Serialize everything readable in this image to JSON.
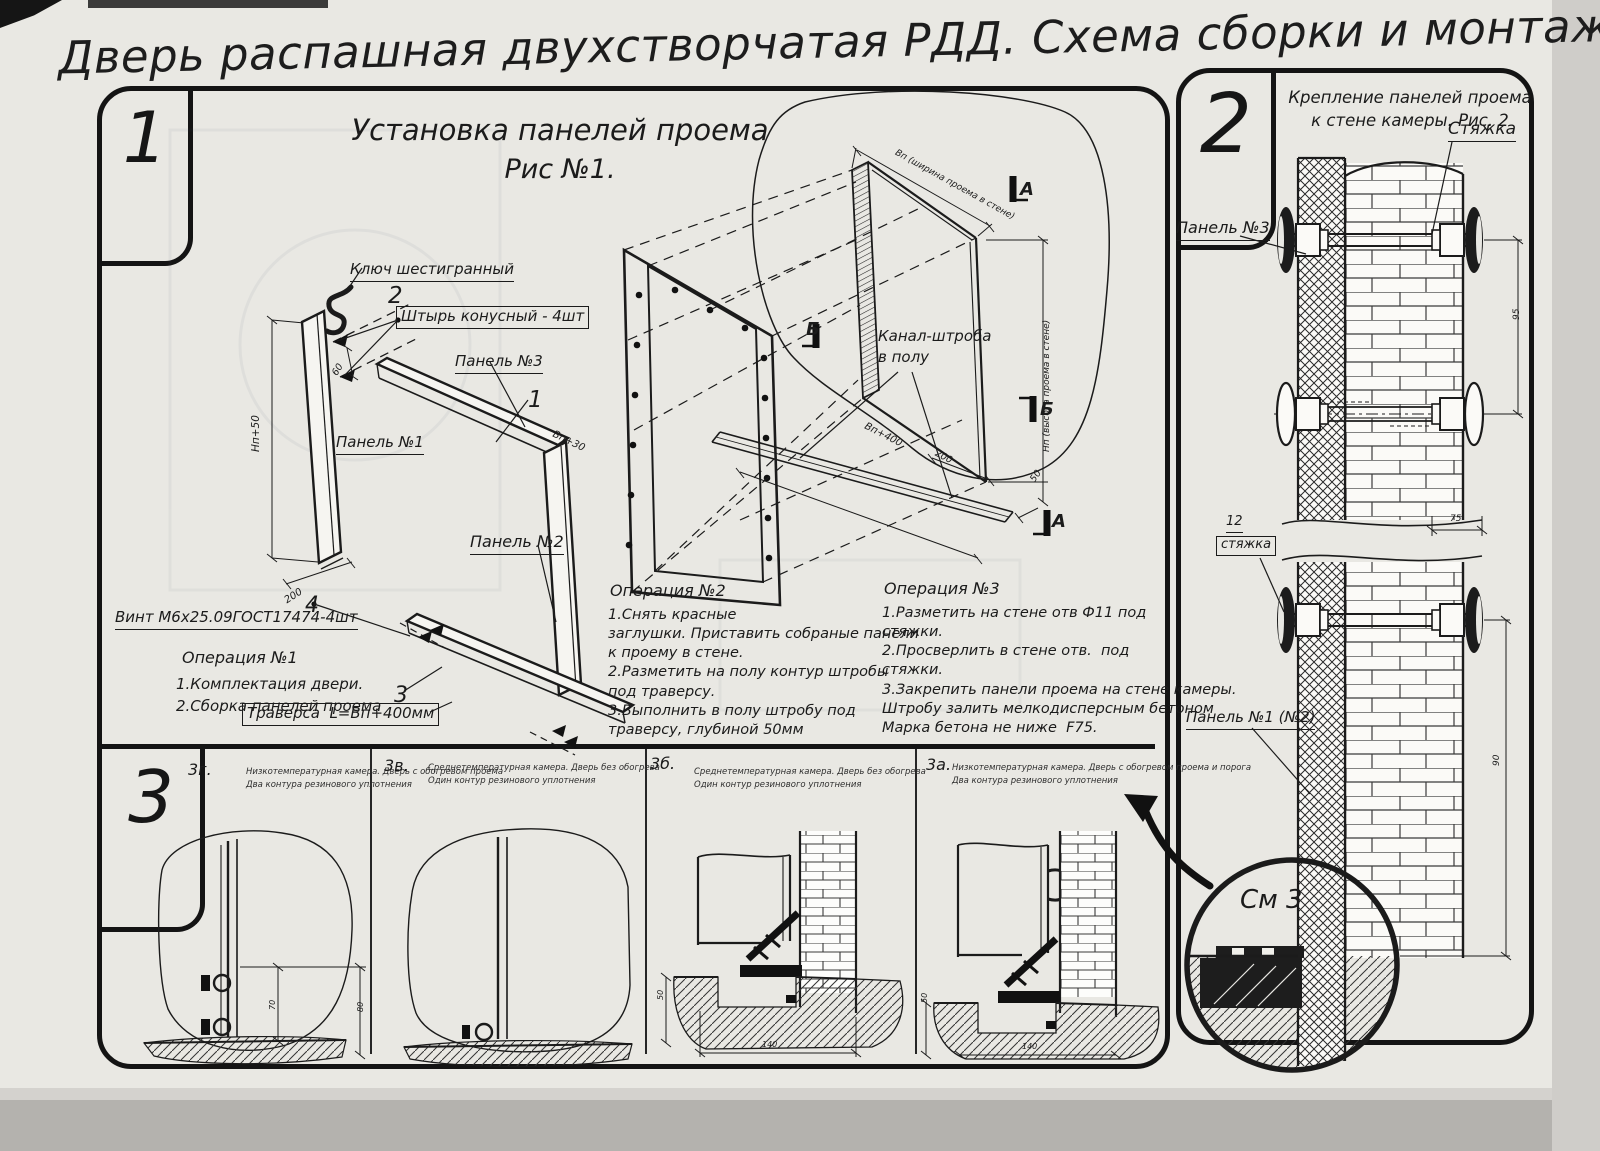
{
  "page": {
    "title": "Дверь распашная двухстворчатая РДД.  Схема сборки и монтажа №2",
    "colors": {
      "ink": "#1b1b1b",
      "paper": "#e9e8e3"
    }
  },
  "fig1": {
    "badge": "1",
    "title": "Установка панелей проема",
    "subtitle": "Рис №1.",
    "labels": {
      "hex_key": "Ключ шестигранный",
      "pin": "Штырь конусный - 4шт",
      "panel3": "Панель №3",
      "panel1": "Панель №1",
      "panel2": "Панель №2",
      "screw": "Винт М6х25.09ГОСТ17474-4шт",
      "traverse": "Траверса  L=Вп+400мм",
      "channel": "Канал-штроба\nв полу",
      "callout_1": "1",
      "callout_2": "2",
      "callout_3": "3",
      "callout_4": "4",
      "marker_a": "А",
      "marker_b": "Б"
    },
    "dims": {
      "np50": "Нп+50",
      "d200": "200",
      "d60": "60",
      "vp30": "Вп+30",
      "width_top": "Вп (ширина проема в стене)",
      "height_right": "Нп (высота проема в стене)",
      "vp400": "Вп+400",
      "d200b": "200",
      "d50": "50"
    },
    "op1": {
      "title": "Операция №1",
      "lines": "1.Комплектация двери.\n2.Сборка панелей проема"
    },
    "op2": {
      "title": "Операция №2",
      "lines": "1.Снять красные\nзаглушки. Приставить собраные панели\nк проему в стене.\n2.Разметить на полу контур штробы\nпод траверсу.\n3.Выполнить в полу штробу под\nтраверсу, глубиной 50мм"
    },
    "op3": {
      "title": "Операция №3",
      "lines": "1.Разметить на стене отв Ф11 под\nстяжки.\n2.Просверлить в стене отв.  под\nстяжки.\n3.Закрепить панели проема на стене камеры.\nШтробу залить мелкодисперсным бетоном\nМарка бетона не ниже  F75."
    }
  },
  "fig3": {
    "badge": "3",
    "subfigs": [
      {
        "label": "3г.",
        "caption": "Низкотемпературная камера. Дверь с обогревом проема\nДва контура резинового уплотнения",
        "dim_inner": "70",
        "dim_outer": "80"
      },
      {
        "label": "3в.",
        "caption": "Среднетемпературная камера. Дверь без обогрева\nОдин контур резинового уплотнения"
      },
      {
        "label": "3б.",
        "caption": "Среднетемпературная камера. Дверь без обогрева\nОдин контур резинового уплотнения",
        "dim_depth": "50",
        "dim_width": "140"
      },
      {
        "label": "3а.",
        "caption": "Низкотемпературная камера. Дверь с обогревом проема и порога\nДва контура резинового уплотнения",
        "dim_depth": "50",
        "dim_width": "140"
      }
    ]
  },
  "fig2": {
    "badge": "2",
    "title": "Крепление панелей проема\nк стене камеры. Рис. 2",
    "labels": {
      "tie_top": "Стяжка",
      "panel3": "Панель №3",
      "tie_num": "12",
      "tie_mid": "стяжка",
      "panel12": "Панель №1 (№2)",
      "detail": "См 3"
    },
    "dims": {
      "d95": "95",
      "d75": "75",
      "d90": "90"
    }
  }
}
